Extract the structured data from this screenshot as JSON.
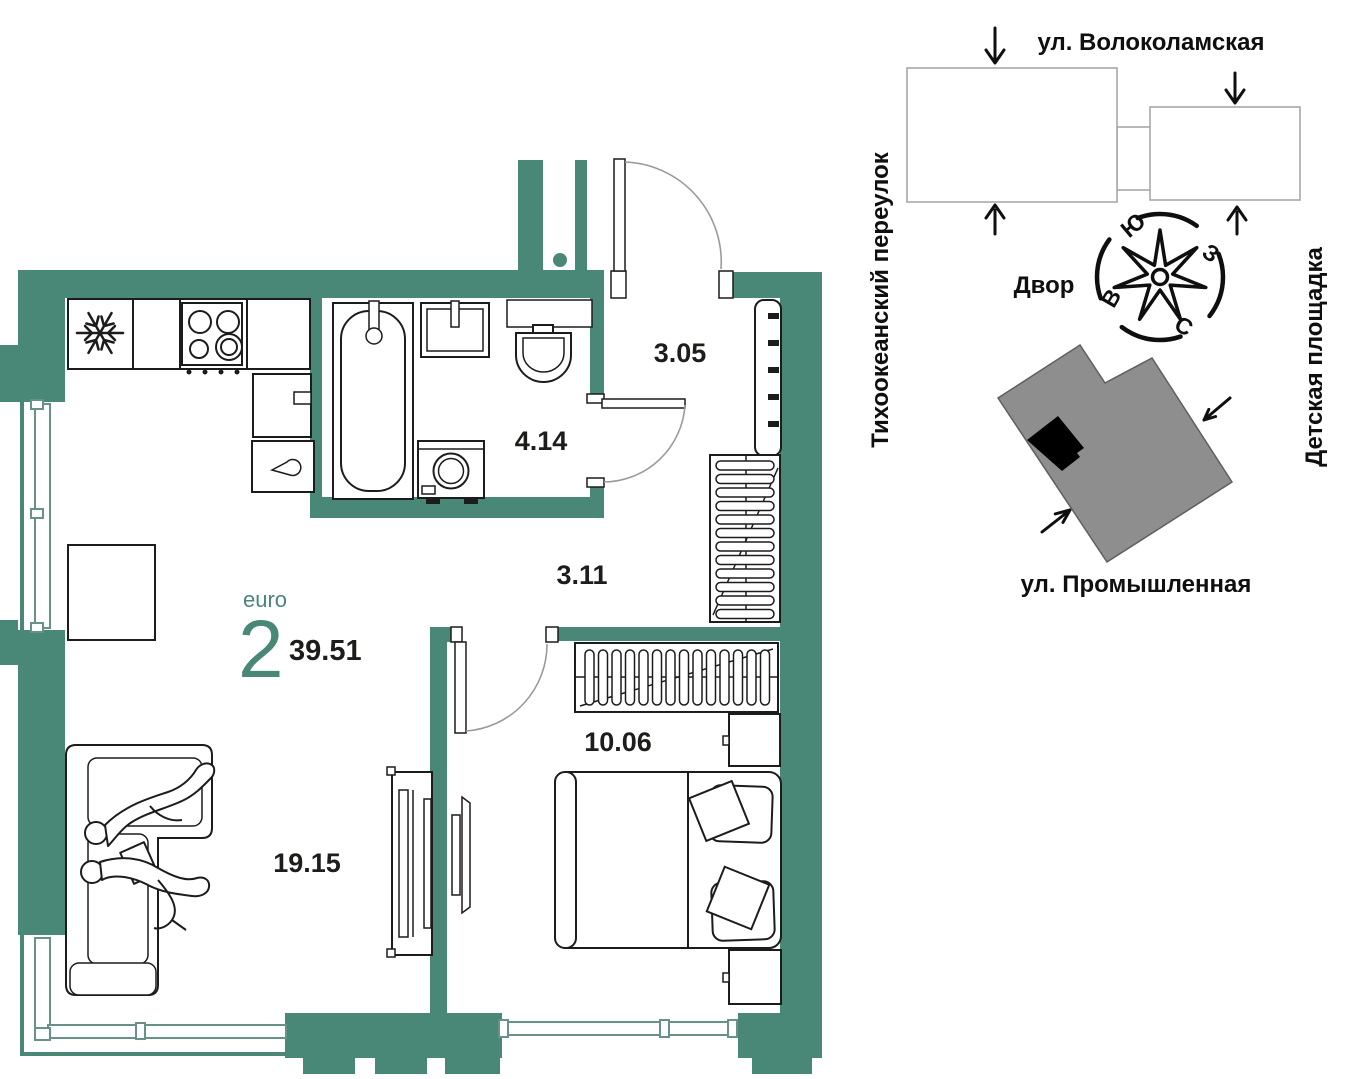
{
  "plan": {
    "euro_label": "euro",
    "rooms_count": "2",
    "total_area": "39.51",
    "areas": {
      "hallway": "3.05",
      "bathroom": "4.14",
      "corridor": "3.11",
      "bedroom": "10.06",
      "living": "19.15"
    }
  },
  "site_plan": {
    "street_top": "ул. Волоколамская",
    "street_left": "Тихоокеанский переулок",
    "street_right": "Детская площадка",
    "street_bottom": "ул. Промышленная",
    "courtyard_label": "Двор",
    "compass": {
      "south": "Ю",
      "west": "З",
      "east": "В",
      "north": "С"
    }
  },
  "colors": {
    "wall_teal": "#498777",
    "accent_teal": "#498777",
    "building_gray": "#8e8e8e",
    "unit_marker_black": "#000000"
  }
}
